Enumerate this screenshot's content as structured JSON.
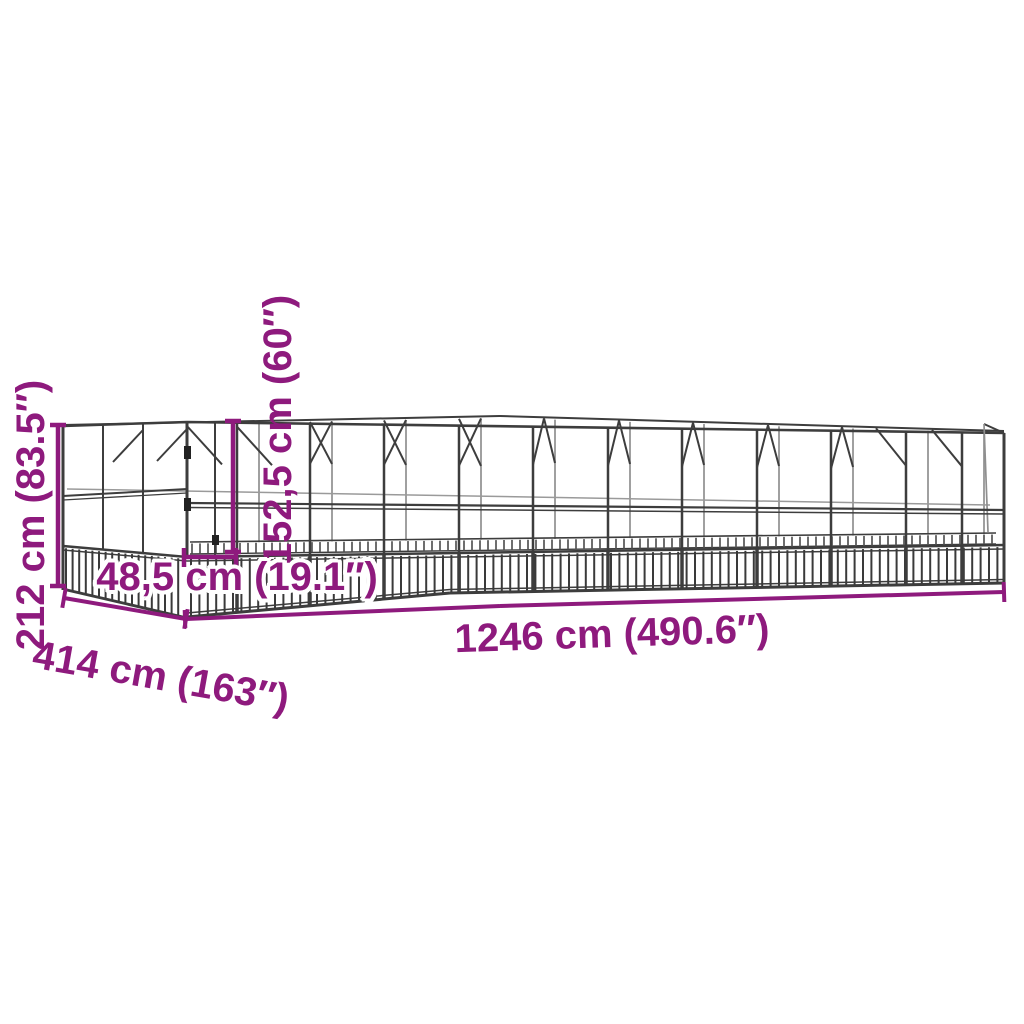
{
  "diagram": {
    "type": "product-dimension-diagram",
    "subject": "large walk-in aviary wireframe drawing",
    "accent_color": "#8e1a7d",
    "structure_color": "#3d3d3d",
    "background_color": "#ffffff",
    "labels": {
      "total_height": "212 cm (83.5″)",
      "door_height": "152,5 cm (60″)",
      "door_width": "48,5 cm (19.1″)",
      "total_length": "1246 cm (490.6″)",
      "total_depth": "414 cm (163″)"
    }
  }
}
